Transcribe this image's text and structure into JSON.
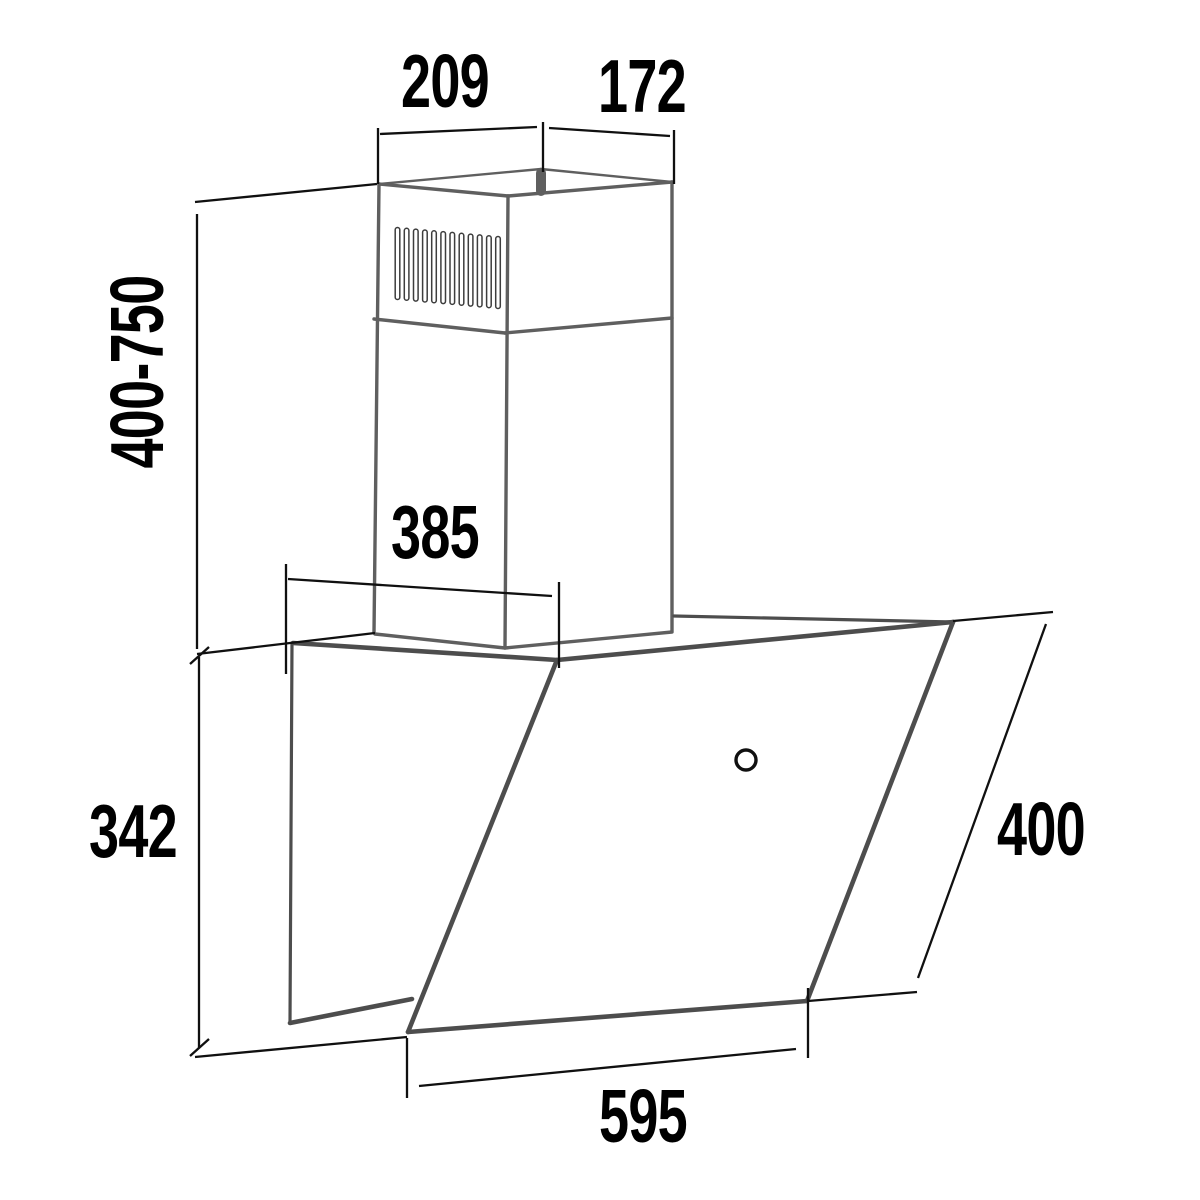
{
  "drawing": {
    "type": "technical-dimension-drawing",
    "subject": "wall-mounted angled cooker hood with telescopic chimney",
    "labels": {
      "chimney_top_width": "209",
      "chimney_top_depth": "172",
      "chimney_height_range": "400-750",
      "hood_top_depth": "385",
      "back_panel_height": "342",
      "glass_panel_height": "400",
      "hood_width": "595"
    },
    "vent_slot_count": 12,
    "colors": {
      "dimension_line": "#101010",
      "product_edge": "#4d4d4d",
      "chimney_edge": "#5f5f5f",
      "background": "#ffffff"
    }
  }
}
